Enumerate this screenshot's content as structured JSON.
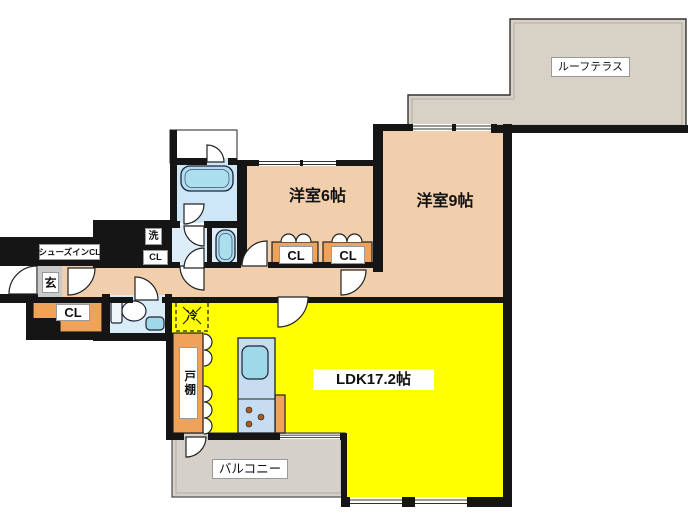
{
  "title": "apartment-floor-plan",
  "colors": {
    "wall": "#151515",
    "peach": "#f1cfad",
    "yellow": "#ffff00",
    "orange": "#efa258",
    "terrace": "#d8d1c6",
    "balcony": "#d5d1ca",
    "bath": "#cde7f7",
    "bath-light": "#ddeefa",
    "toilet-room": "#d9edf8",
    "fixture": "#abdfee",
    "counter": "#c6ddf1",
    "sink": "#9fd8e9",
    "genkan": "#c9c9c9",
    "washer-box": "#cfeaf6",
    "burner": "#a85a20",
    "label-bg": "#ffffff"
  },
  "labels": {
    "roof_terrace": "ルーフテラス",
    "western_room_6": "洋室6帖",
    "western_room_9": "洋室9帖",
    "ldk": "LDK17.2帖",
    "balcony": "バルコニー",
    "shoes_in_closet": "シューズインCL",
    "entrance": "玄",
    "closet_hall": "CL",
    "closet_laundry": "CL",
    "washer": "洗",
    "closet_bedroom_1": "CL",
    "closet_bedroom_2": "CL",
    "refrigerator": "冷",
    "cupboard": "戸棚"
  }
}
